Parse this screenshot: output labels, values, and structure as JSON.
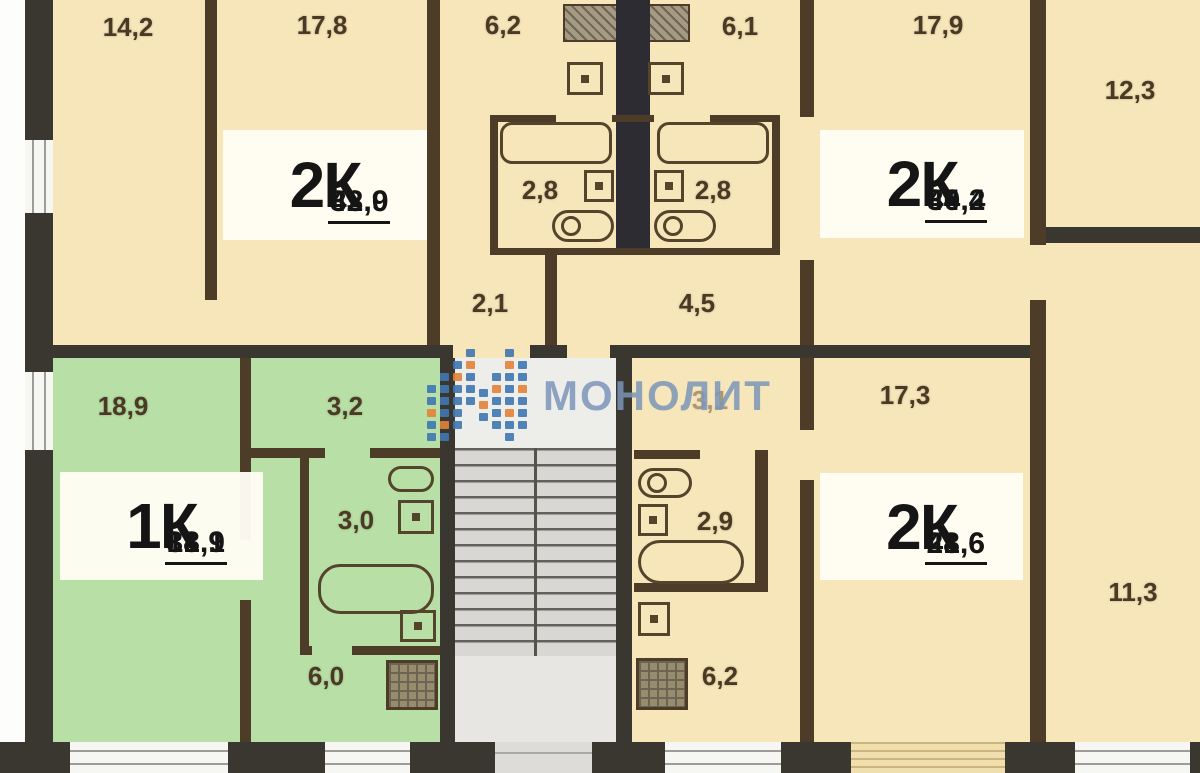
{
  "plan_title": "apartment-floor-plan",
  "watermark": {
    "text": "МОНОЛИТ",
    "logo_blue": "#4077b3",
    "logo_orange": "#e5823a"
  },
  "apartments": {
    "top_left": {
      "type": "2К",
      "total_area": "43,9",
      "living_area": "32,0"
    },
    "top_right": {
      "type": "2К",
      "total_area": "44,4",
      "living_area": "30,2"
    },
    "bottom_left": {
      "type": "1К",
      "total_area": "31,1",
      "living_area": "18,9"
    },
    "bottom_right": {
      "type": "2К",
      "total_area": "41,6",
      "living_area": "28,6"
    }
  },
  "rooms": {
    "tl_room1": "14,2",
    "tl_room2": "17,8",
    "tl_kitchen": "6,2",
    "tl_bath": "2,8",
    "tl_hall": "2,1",
    "tr_kitchen": "6,1",
    "tr_room1": "17,9",
    "tr_room2": "12,3",
    "tr_bath": "2,8",
    "tr_hall": "4,5",
    "bl_room1": "18,9",
    "bl_hall": "3,2",
    "bl_bath": "3,0",
    "bl_kitchen": "6,0",
    "br_hall": "3,1",
    "br_bath": "2,9",
    "br_room1": "17,3",
    "br_kitchen": "6,2",
    "br_room2": "11,3"
  },
  "palette": {
    "room_tan": "#f7e6ba",
    "room_green": "#b7dfa6",
    "stair_gray": "#d8d7d3",
    "wall_dark": "#3a3731",
    "wall_brown": "#4c3c28",
    "shaft_dark": "#2e2c33",
    "label_bg": "#fffdf4",
    "area_text": "#4a3a25",
    "watermark_blue": "#7a94b8"
  }
}
